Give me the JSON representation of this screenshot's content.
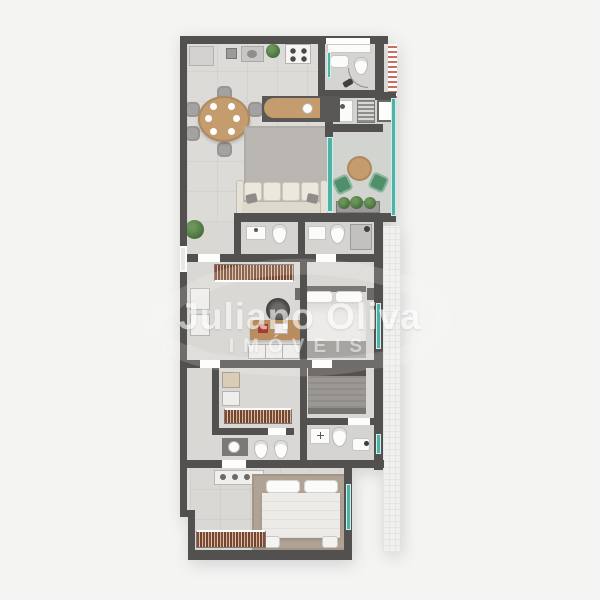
{
  "watermark": {
    "line1": "Juliano Oliva",
    "line2": "IMÓVEIS"
  },
  "colors": {
    "bg": "#f4f4f3",
    "wall": "#535150",
    "floor": "#dcdbd8",
    "floor-warm": "#dad8d4",
    "bath-floor": "#d5d4d1",
    "balcony-floor": "#d2d4d0",
    "wood": "#c59c6e",
    "wood-dark": "#b98d5f",
    "glass": "#4db3a6",
    "rug": "#bab7b3",
    "master-rug": "#b0a294",
    "sofa": "#e6e1d6",
    "bed-white": "#edebe7",
    "bed-gray": "#9b9894",
    "blanket": "#a7a5a1",
    "plant": "#527c46",
    "hatch-red": "#c9705f",
    "dark-fixture": "#403f3e",
    "chair-gray": "#a3a2a0",
    "balcony-chair": "#4f8f6a",
    "watermark": "#ffffff"
  }
}
